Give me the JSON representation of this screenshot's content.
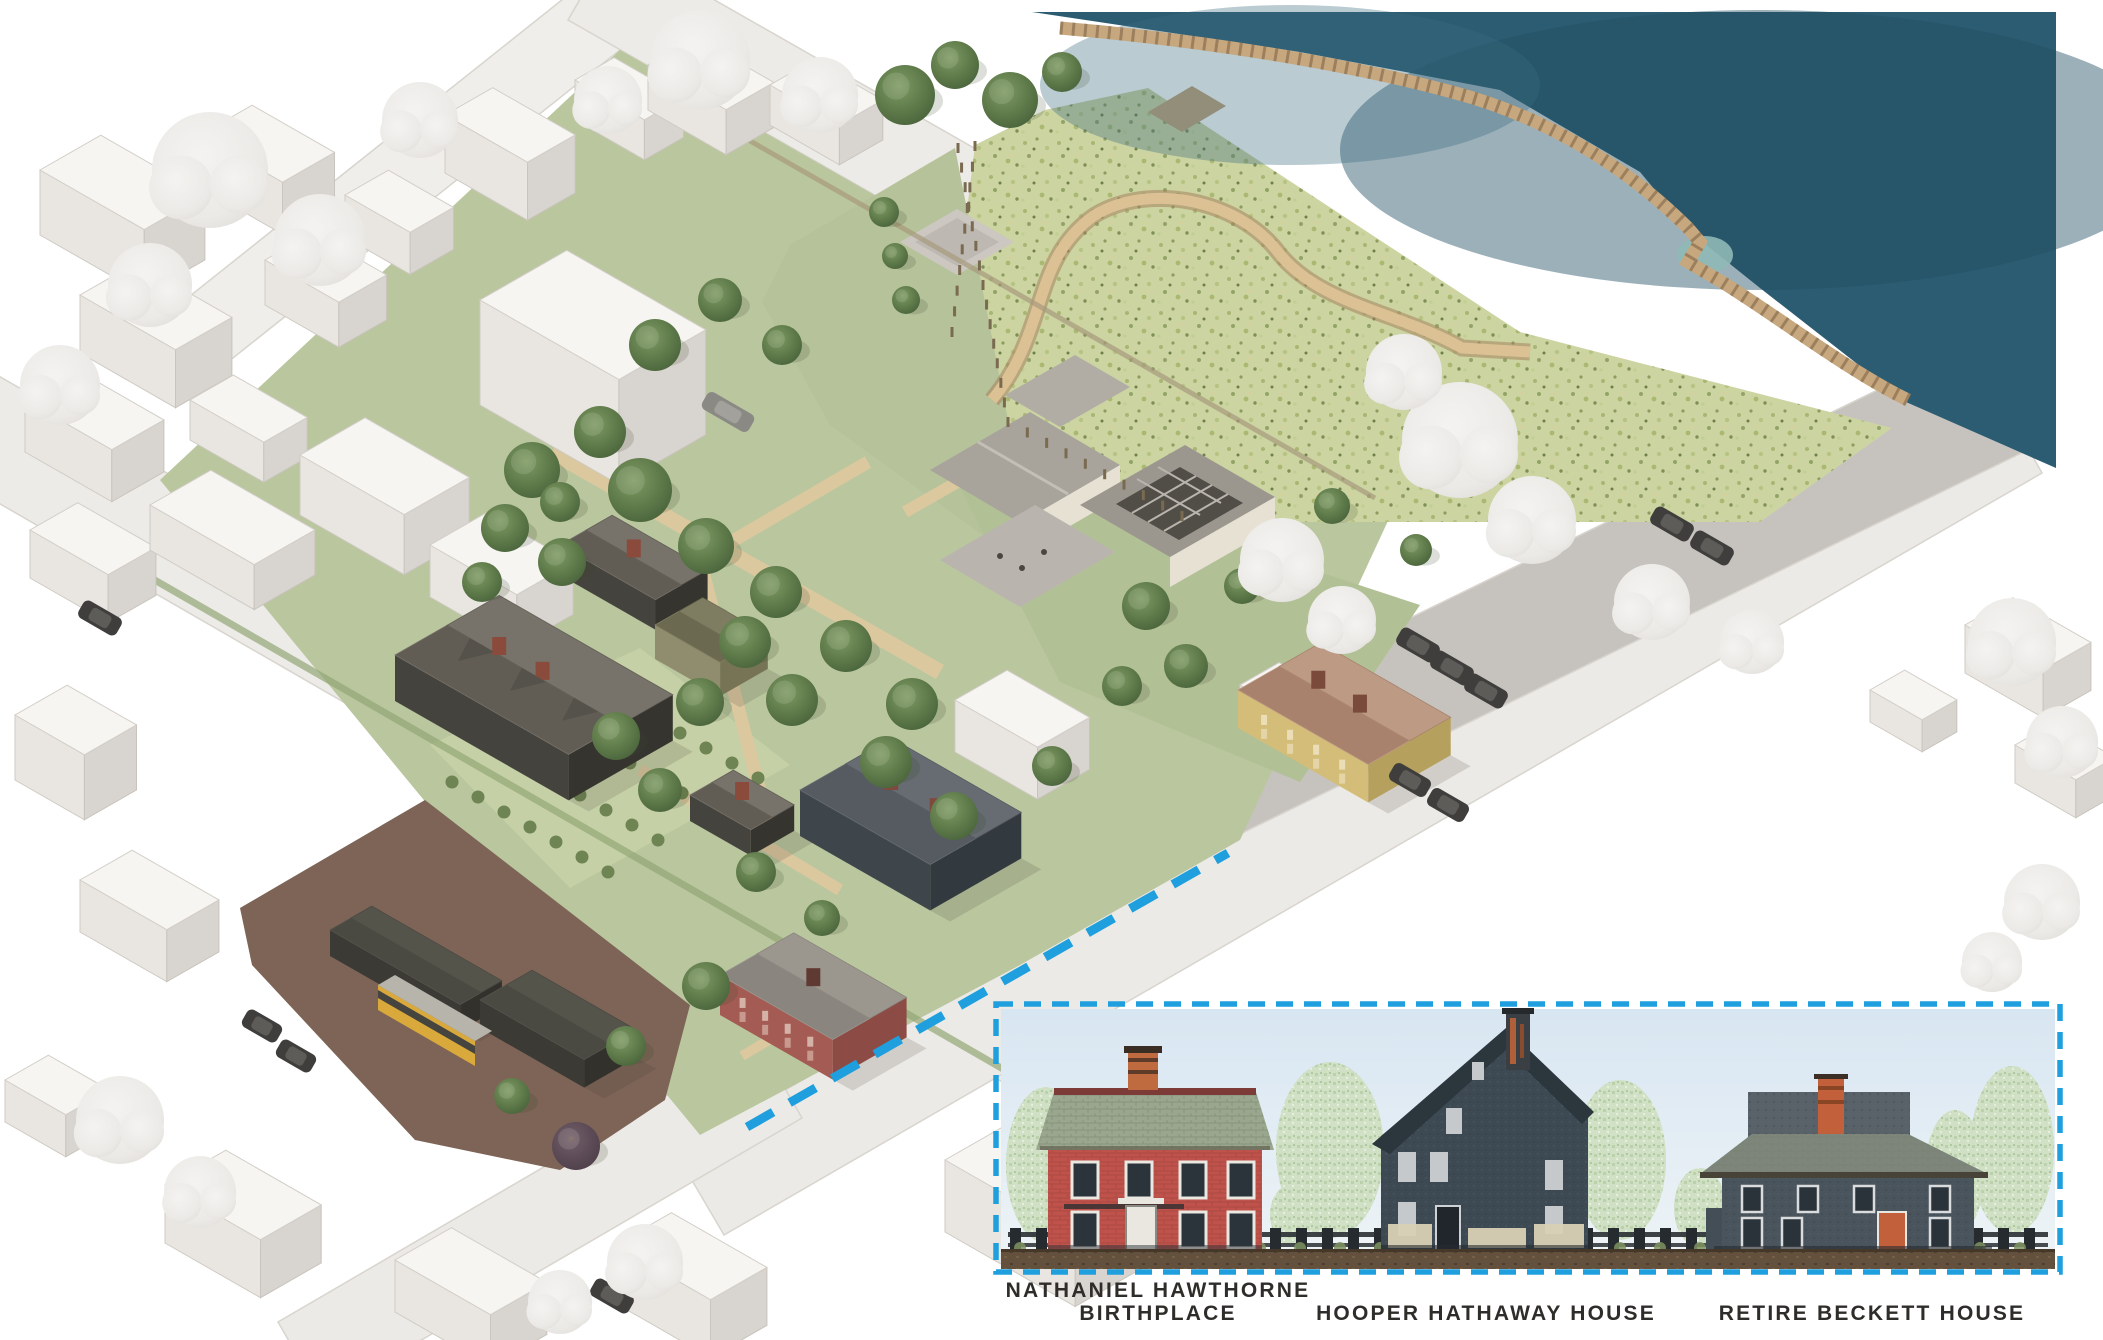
{
  "palette": {
    "accent_blue": "#1f9fdd",
    "water": "#2b5c72",
    "meadow_green": "#ccd5a2",
    "lawn_green": "#b5c29a",
    "label_text": "#2e2d2a",
    "inset_sky": "#dbe8f3"
  },
  "inset": {
    "houses": [
      {
        "name": "nathaniel-hawthorne-birthplace",
        "label_line1": "NATHANIEL HAWTHORNE",
        "label_line2": "BIRTHPLACE"
      },
      {
        "name": "hooper-hathaway-house",
        "label_line1": "HOOPER HATHAWAY HOUSE",
        "label_line2": ""
      },
      {
        "name": "retire-beckett-house",
        "label_line1": "RETIRE BECKETT HOUSE",
        "label_line2": ""
      }
    ]
  }
}
